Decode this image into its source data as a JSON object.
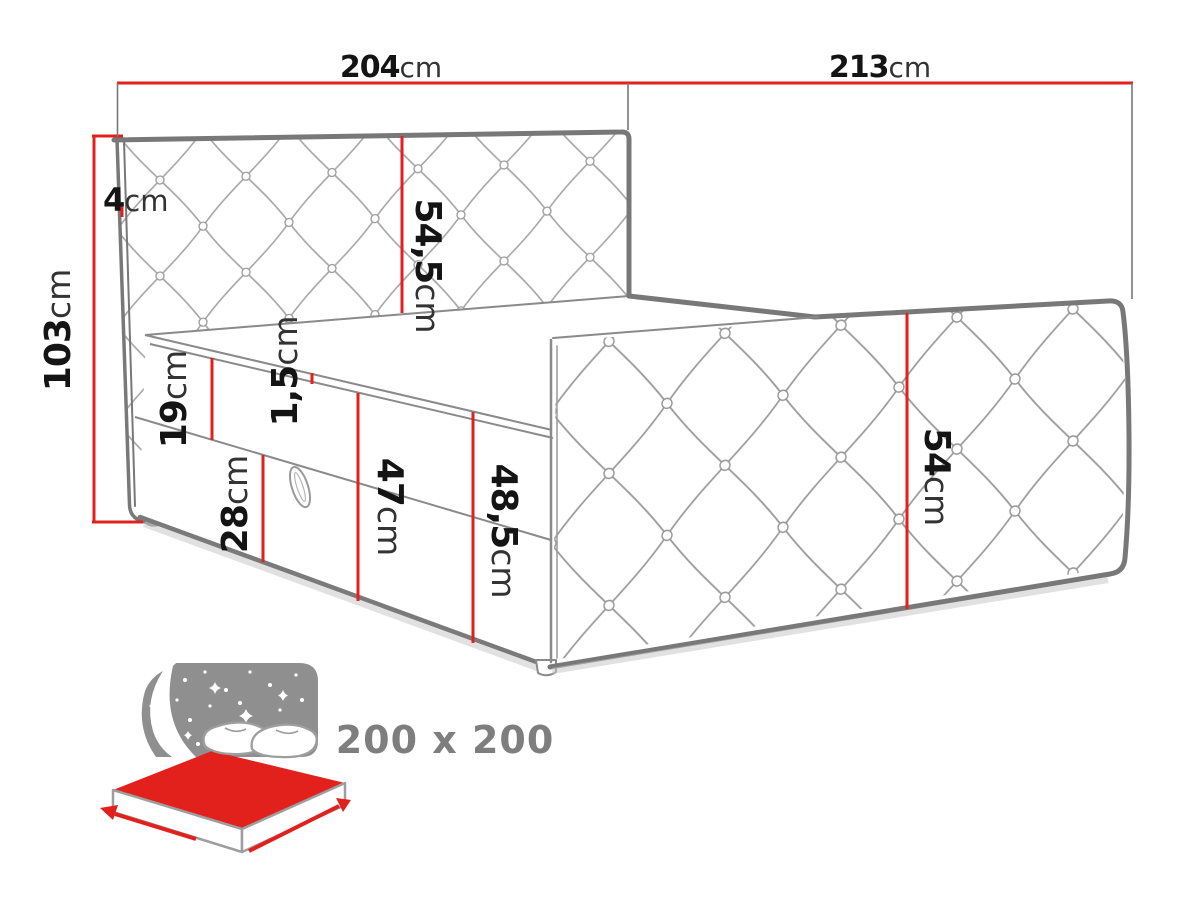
{
  "diagram": {
    "title_semantic": "boxspring-bed-dimension-diagram",
    "dimensions": [
      {
        "id": "headboard-width",
        "value": "204",
        "unit": "cm"
      },
      {
        "id": "bed-length",
        "value": "213",
        "unit": "cm"
      },
      {
        "id": "total-height",
        "value": "103",
        "unit": "cm"
      },
      {
        "id": "headboard-edge",
        "value": "4",
        "unit": "cm"
      },
      {
        "id": "headboard-panel",
        "value": "54,5",
        "unit": "cm"
      },
      {
        "id": "topper-height",
        "value": "1,5",
        "unit": "cm"
      },
      {
        "id": "mattress-height",
        "value": "19",
        "unit": "cm"
      },
      {
        "id": "storage-base-height",
        "value": "28",
        "unit": "cm"
      },
      {
        "id": "sleep-surface-height",
        "value": "47",
        "unit": "cm"
      },
      {
        "id": "topper-top-height",
        "value": "48,5",
        "unit": "cm"
      },
      {
        "id": "side-panel-height",
        "value": "54",
        "unit": "cm"
      }
    ],
    "size_label": "200 x 200",
    "colors": {
      "dimension_red": "#e2211c",
      "outline_gray": "#7a7a7a",
      "lattice_gray": "#a6a6a6",
      "icon_gray": "#8f8f8f",
      "text_black": "#141414",
      "size_text_gray": "#7e7e7e"
    }
  }
}
